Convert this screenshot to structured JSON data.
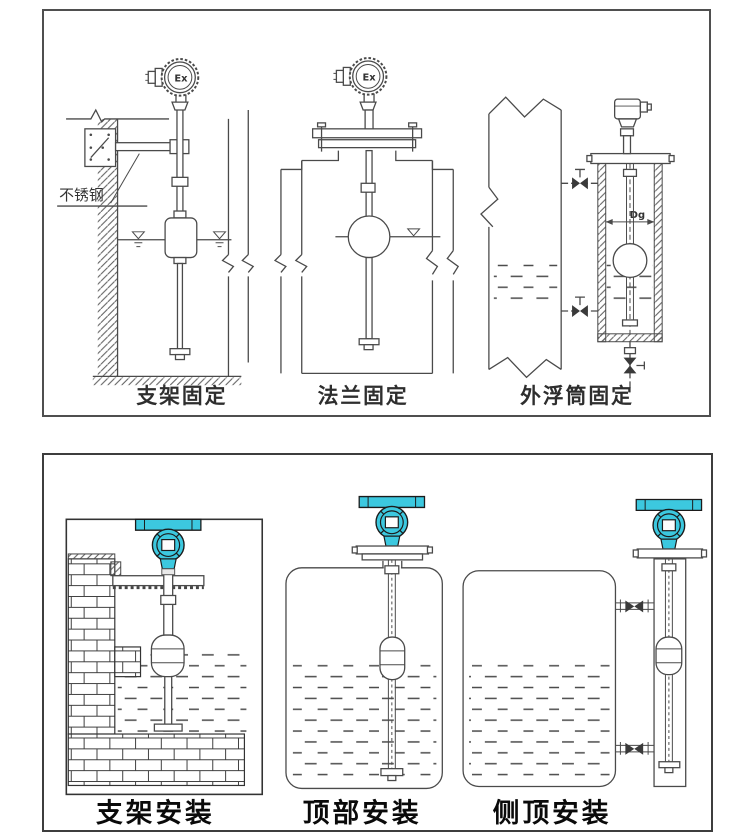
{
  "figure": {
    "description": "Float level transmitter installation diagrams",
    "top_panel": {
      "figures": [
        {
          "caption": "支架固定",
          "material_label": "不锈钢",
          "head_label": "Ex"
        },
        {
          "caption": "法兰固定",
          "head_label": "Ex"
        },
        {
          "caption": "外浮筒固定",
          "diameter_label": "Dg"
        }
      ]
    },
    "bottom_panel": {
      "figures": [
        {
          "caption": "支架安装"
        },
        {
          "caption": "顶部安装"
        },
        {
          "caption": "侧顶安装"
        }
      ]
    },
    "colors": {
      "transmitter_teal": "#3cc8df",
      "line": "#4a4a4a",
      "page_background": "#ffffff"
    }
  }
}
